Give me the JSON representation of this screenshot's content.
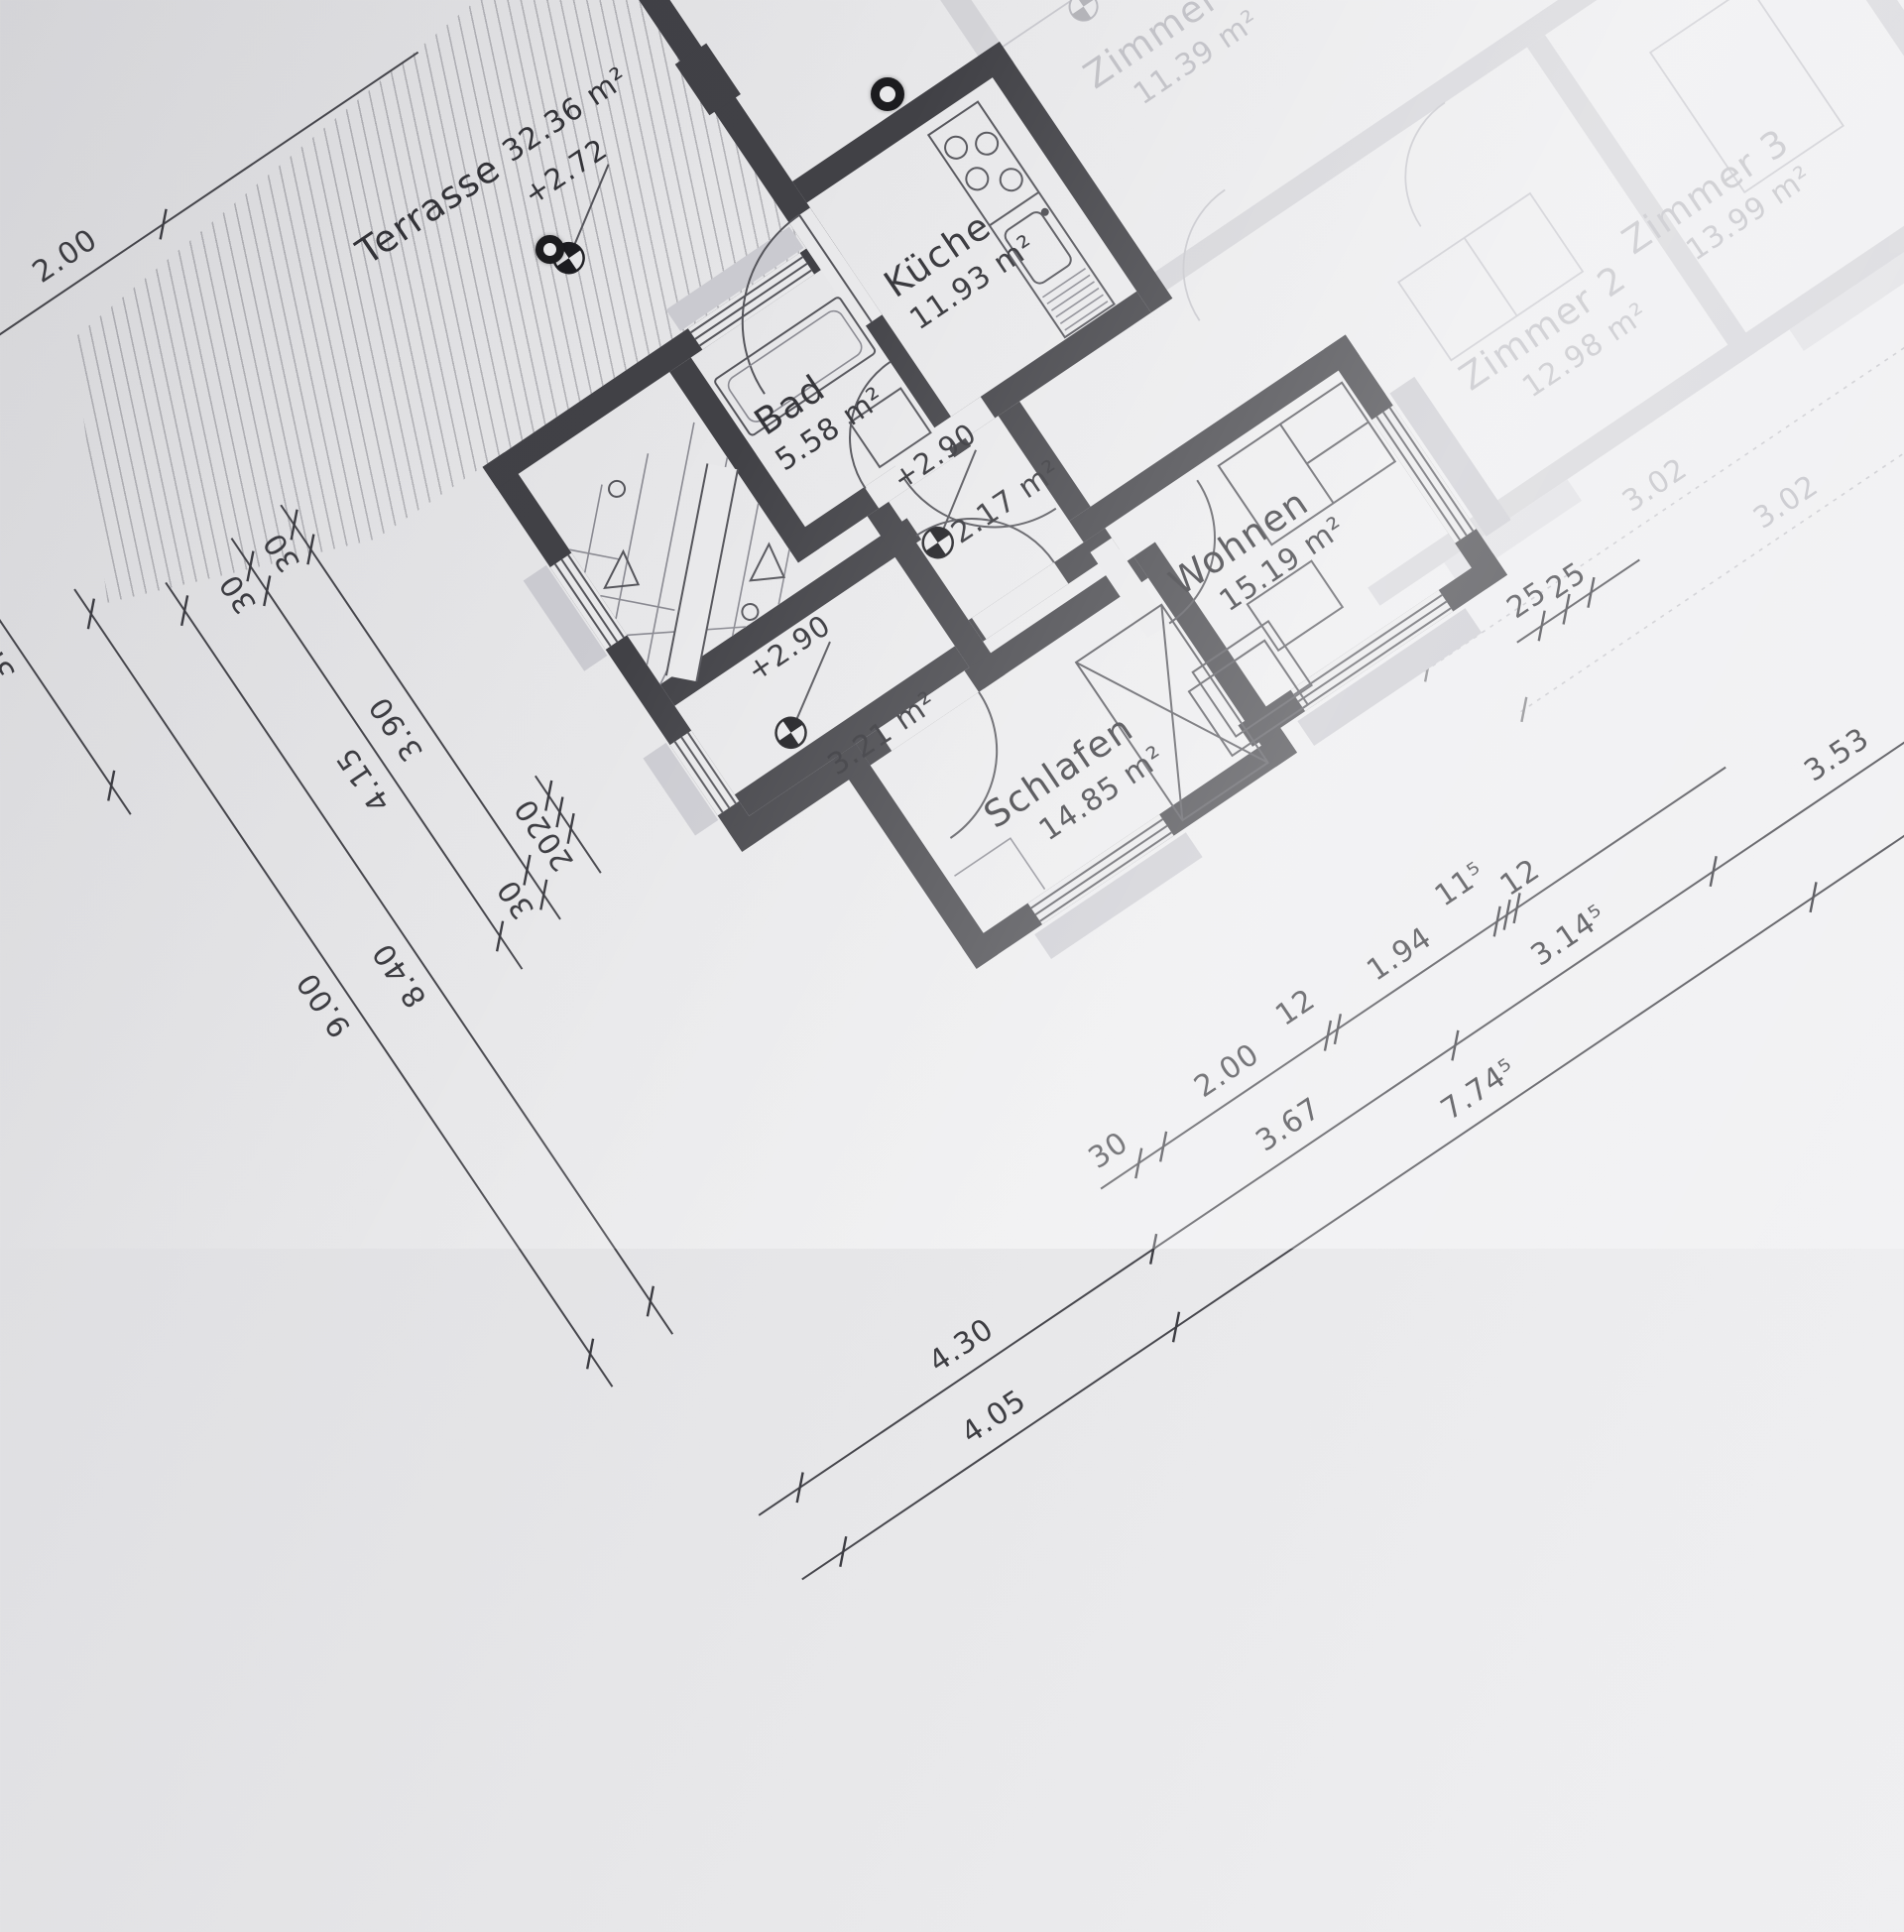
{
  "rooms": {
    "terrasse": {
      "name": "Terrasse",
      "area": "32.36 m²",
      "level": "+2.72"
    },
    "kueche": {
      "name": "Küche",
      "area": "11.93 m²"
    },
    "bad": {
      "name": "Bad",
      "area": "5.58 m²"
    },
    "wohnen": {
      "name": "Wohnen",
      "area": "15.19 m²"
    },
    "schlafen": {
      "name": "Schlafen",
      "area": "14.85 m²"
    },
    "korridor": {
      "area": "2.17 m²",
      "level": "+2.90"
    },
    "flur": {
      "area": "3.21 m²",
      "level": "+2.90"
    }
  },
  "faded_rooms": {
    "zimmer1": {
      "name": "Zimmer",
      "area": "11.39 m²",
      "level": "+2.90"
    },
    "zimmer2": {
      "name": "Zimmer 2",
      "area": "12.98 m²"
    },
    "zimmer3": {
      "name": "Zimmer 3",
      "area": "13.99 m²"
    }
  },
  "dimensions": {
    "top": [
      "30",
      "2.00"
    ],
    "bottom1": [
      "30",
      "2.00",
      "12",
      "1.94",
      "11⁵",
      "12"
    ],
    "bottom2": [
      "4.30",
      "3.67",
      "3.14⁵",
      "3.53"
    ],
    "bottom3": [
      "4.05",
      "7.74⁵"
    ],
    "right25": [
      "25",
      "25"
    ],
    "left_small": [
      "20",
      "20"
    ],
    "left1": [
      "30",
      "3.90",
      "30"
    ],
    "left2": [
      "30",
      "4.15"
    ],
    "left3": [
      "8.40"
    ],
    "left4": [
      "9.00"
    ],
    "left_terrace": [
      "3.75"
    ],
    "faded_right": [
      "3.02",
      "10",
      "3.02"
    ]
  },
  "colors": {
    "paper": "#e9e9eb",
    "wall": "#414146",
    "line": "#55555b",
    "faded": "#b2b2ba"
  }
}
